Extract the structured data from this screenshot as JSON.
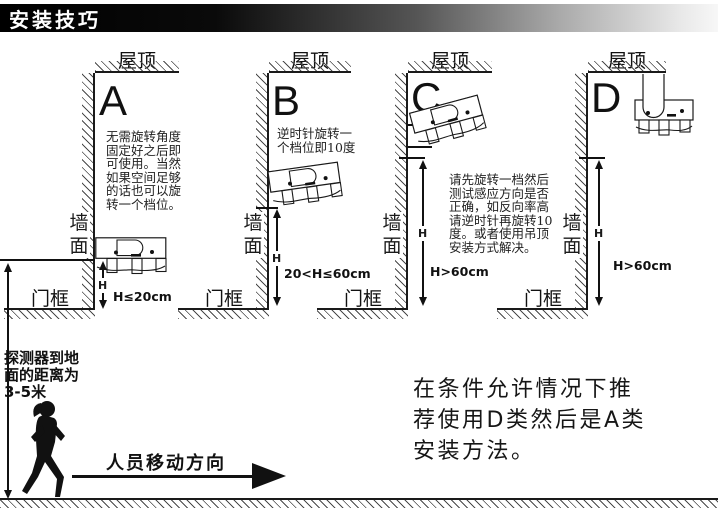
{
  "banner": {
    "title": "安装技巧"
  },
  "panels": [
    {
      "id": "A",
      "letter": "A",
      "roof_label": "屋顶",
      "wall_label_chars": [
        "墙",
        "面"
      ],
      "door_label": "门框",
      "h_label": "H",
      "height_range": "H≤20cm",
      "note_lines": [
        "无需旋转角度",
        "固定好之后即",
        "可使用。当然",
        "如果空间足够",
        "的话也可以旋",
        "转一个档位。"
      ]
    },
    {
      "id": "B",
      "letter": "B",
      "roof_label": "屋顶",
      "wall_label_chars": [
        "墙",
        "面"
      ],
      "door_label": "门框",
      "h_label": "H",
      "height_range": "20<H≤60cm",
      "note_lines": [
        "逆时针旋转一",
        "个档位即10度"
      ]
    },
    {
      "id": "C",
      "letter": "C",
      "roof_label": "屋顶",
      "wall_label_chars": [
        "墙",
        "面"
      ],
      "door_label": "门框",
      "h_label": "H",
      "height_range": "H>60cm",
      "note_lines": [
        "请先旋转一档然后",
        "测试感应方向是否",
        "正确，如反向率高",
        "请逆时针再旋转10",
        "度。或者使用吊顶",
        "安装方式解决。"
      ]
    },
    {
      "id": "D",
      "letter": "D",
      "roof_label": "屋顶",
      "wall_label_chars": [
        "墙",
        "面"
      ],
      "door_label": "门框",
      "h_label": "H",
      "height_range": "H>60cm",
      "note_lines": []
    }
  ],
  "left_annotation": {
    "lines": [
      "探测器到地",
      "面的距离为",
      "3-5米"
    ]
  },
  "movement": {
    "label": "人员移动方向"
  },
  "recommendation": {
    "lines": [
      "在条件允许情况下推",
      "荐使用D类然后是A类",
      "安装方法。"
    ]
  },
  "colors": {
    "ink": "#1a1a1a",
    "banner_start": "#000000",
    "banner_end": "#f7f7f7",
    "background": "#ffffff"
  }
}
